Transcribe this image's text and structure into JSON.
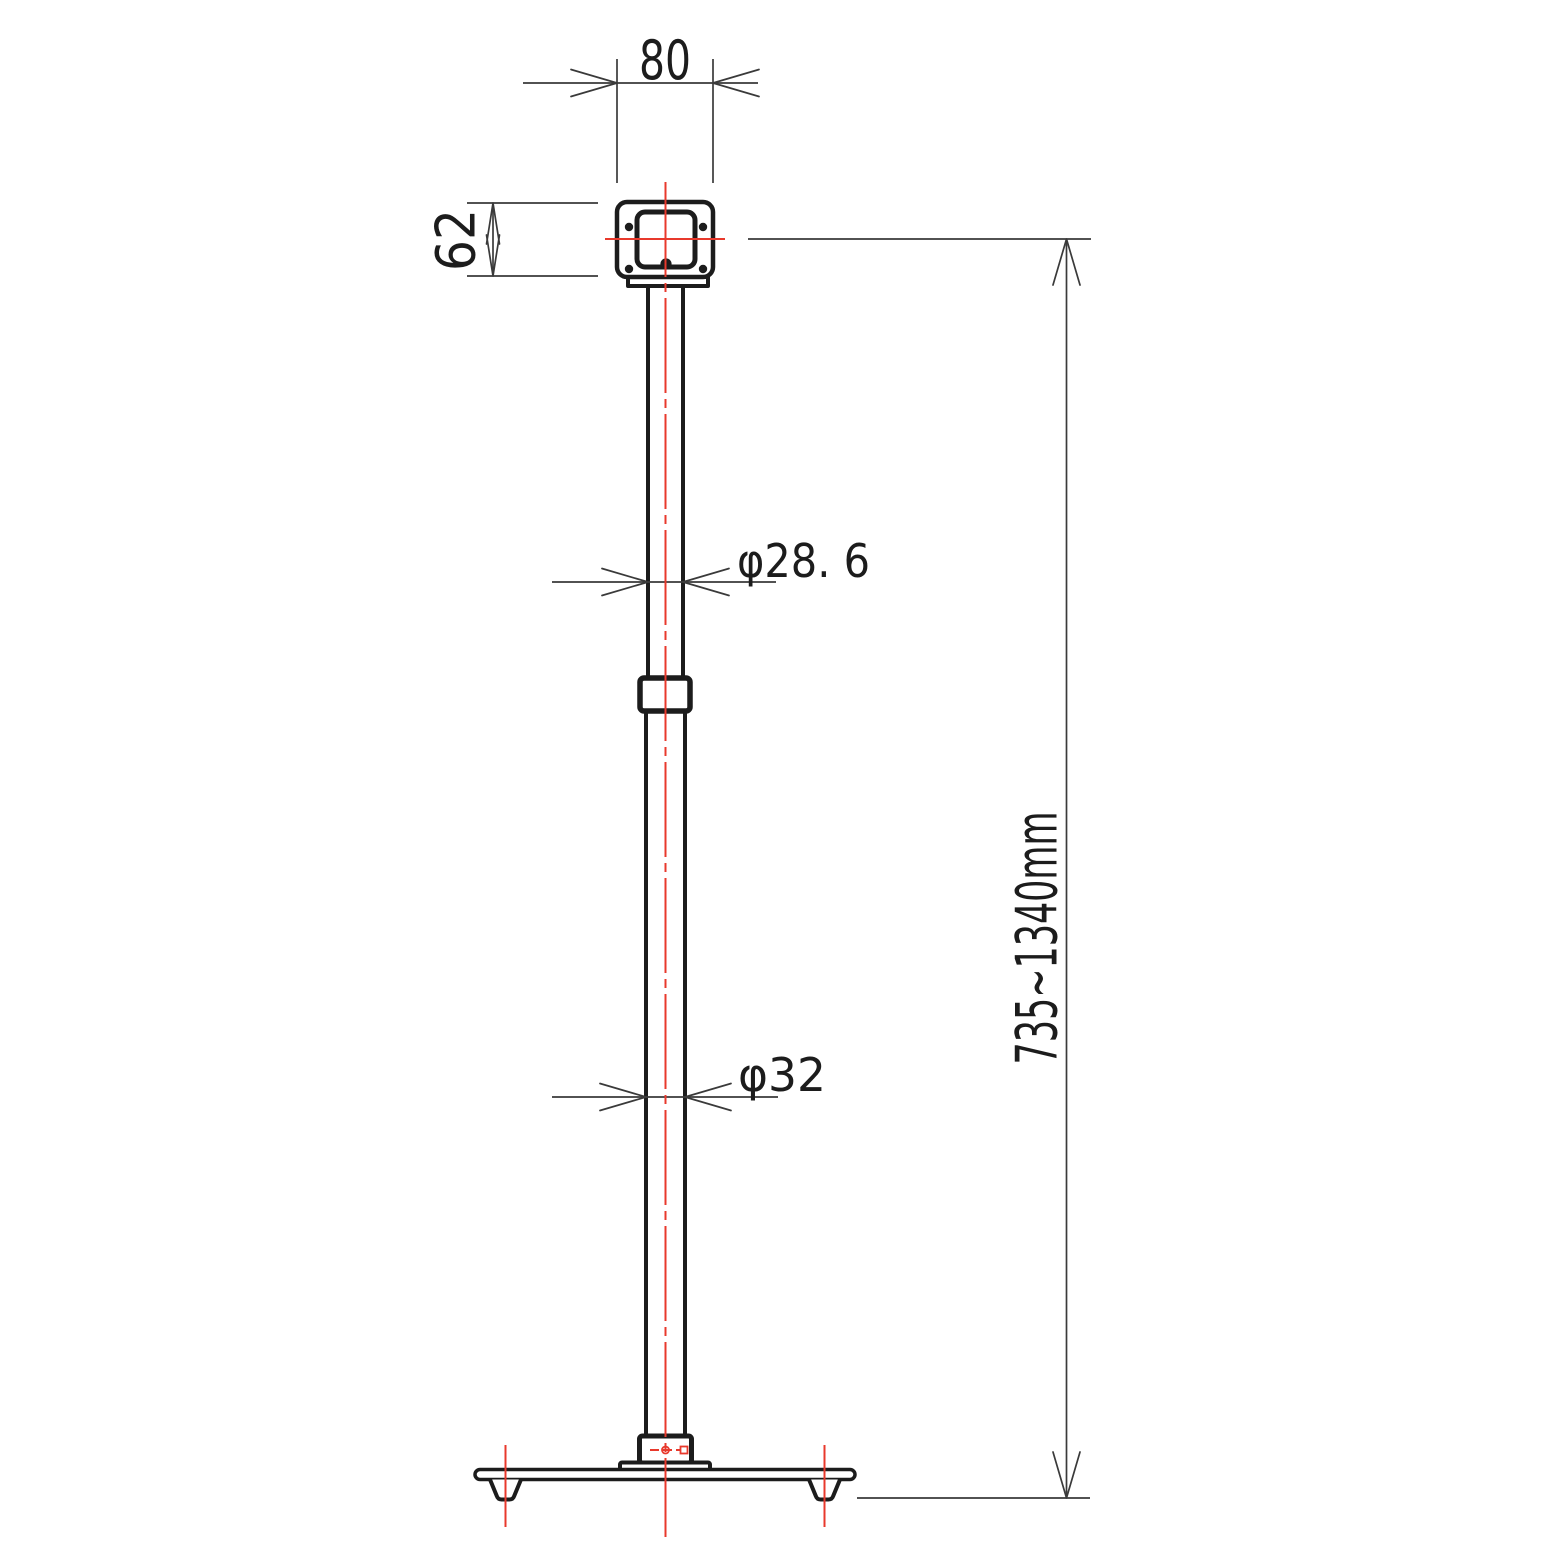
{
  "drawing": {
    "kind": "technical-drawing",
    "subject": "height-adjustable pole stand with square mounting plate and weighted base",
    "view": "front elevation",
    "units": "mm"
  },
  "dimensions": {
    "top_width": "80",
    "plate_height": "62",
    "upper_pole_diameter": "φ28. 6",
    "lower_pole_diameter": "φ32",
    "overall_height_range": "735~1340mm"
  },
  "colors": {
    "outline": "#1c1c1c",
    "dimension_line": "#3a3a3a",
    "centerline_red": "#e8392c",
    "background": "#ffffff"
  }
}
